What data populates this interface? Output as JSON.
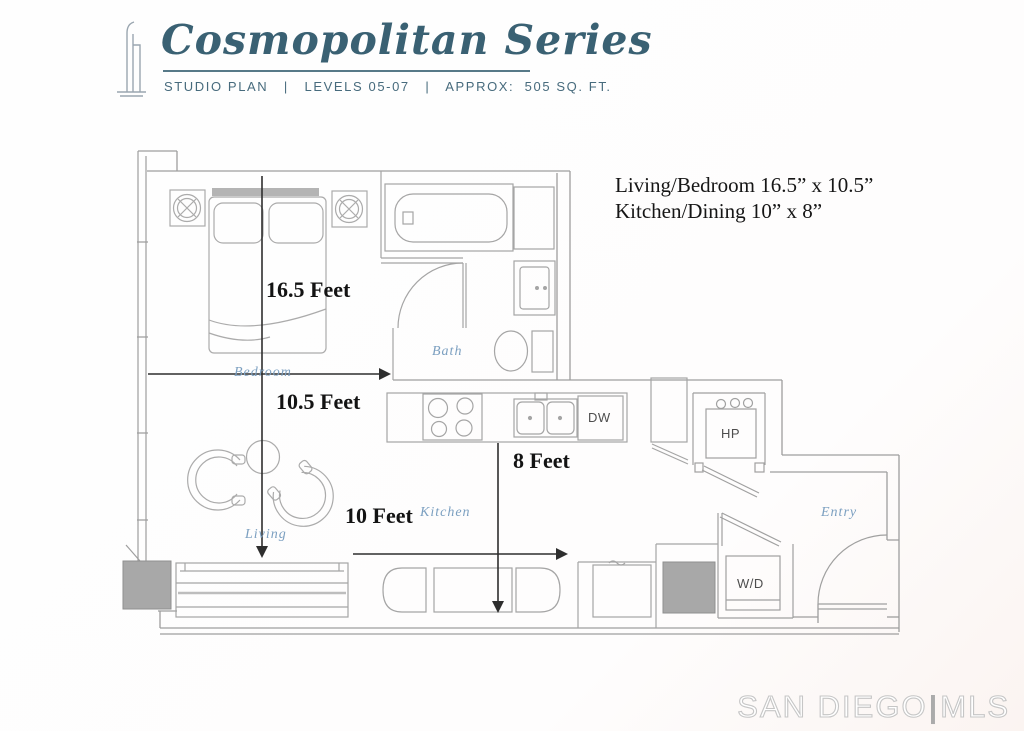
{
  "header": {
    "brand": "Cosmopolitan Series",
    "subtitle": "STUDIO PLAN   |   LEVELS 05-07   |   APPROX:  505 SQ. FT."
  },
  "notes": {
    "line1": "Living/Bedroom 16.5” x 10.5”",
    "line2": "Kitchen/Dining 10” x 8”"
  },
  "dimensions": {
    "bedroom_length": "16.5 Feet",
    "bedroom_width": "10.5 Feet",
    "kitchen_depth": "8 Feet",
    "kitchen_width": "10 Feet"
  },
  "rooms": {
    "bedroom": "Bedroom",
    "bath": "Bath",
    "kitchen": "Kitchen",
    "living": "Living",
    "entry": "Entry"
  },
  "labels": {
    "dishwasher": "DW",
    "heat_pump": "HP",
    "washer_dryer": "W/D"
  },
  "watermark": {
    "city": "SAN DIEGO",
    "divider": "|",
    "org": "MLS"
  },
  "colors": {
    "brand_teal": "#3a6173",
    "script_blue": "#7b9fc0",
    "wall_gray": "#9e9e9e",
    "dimension_black": "#2e2e2e",
    "column_gray": "#a8a8a8"
  }
}
